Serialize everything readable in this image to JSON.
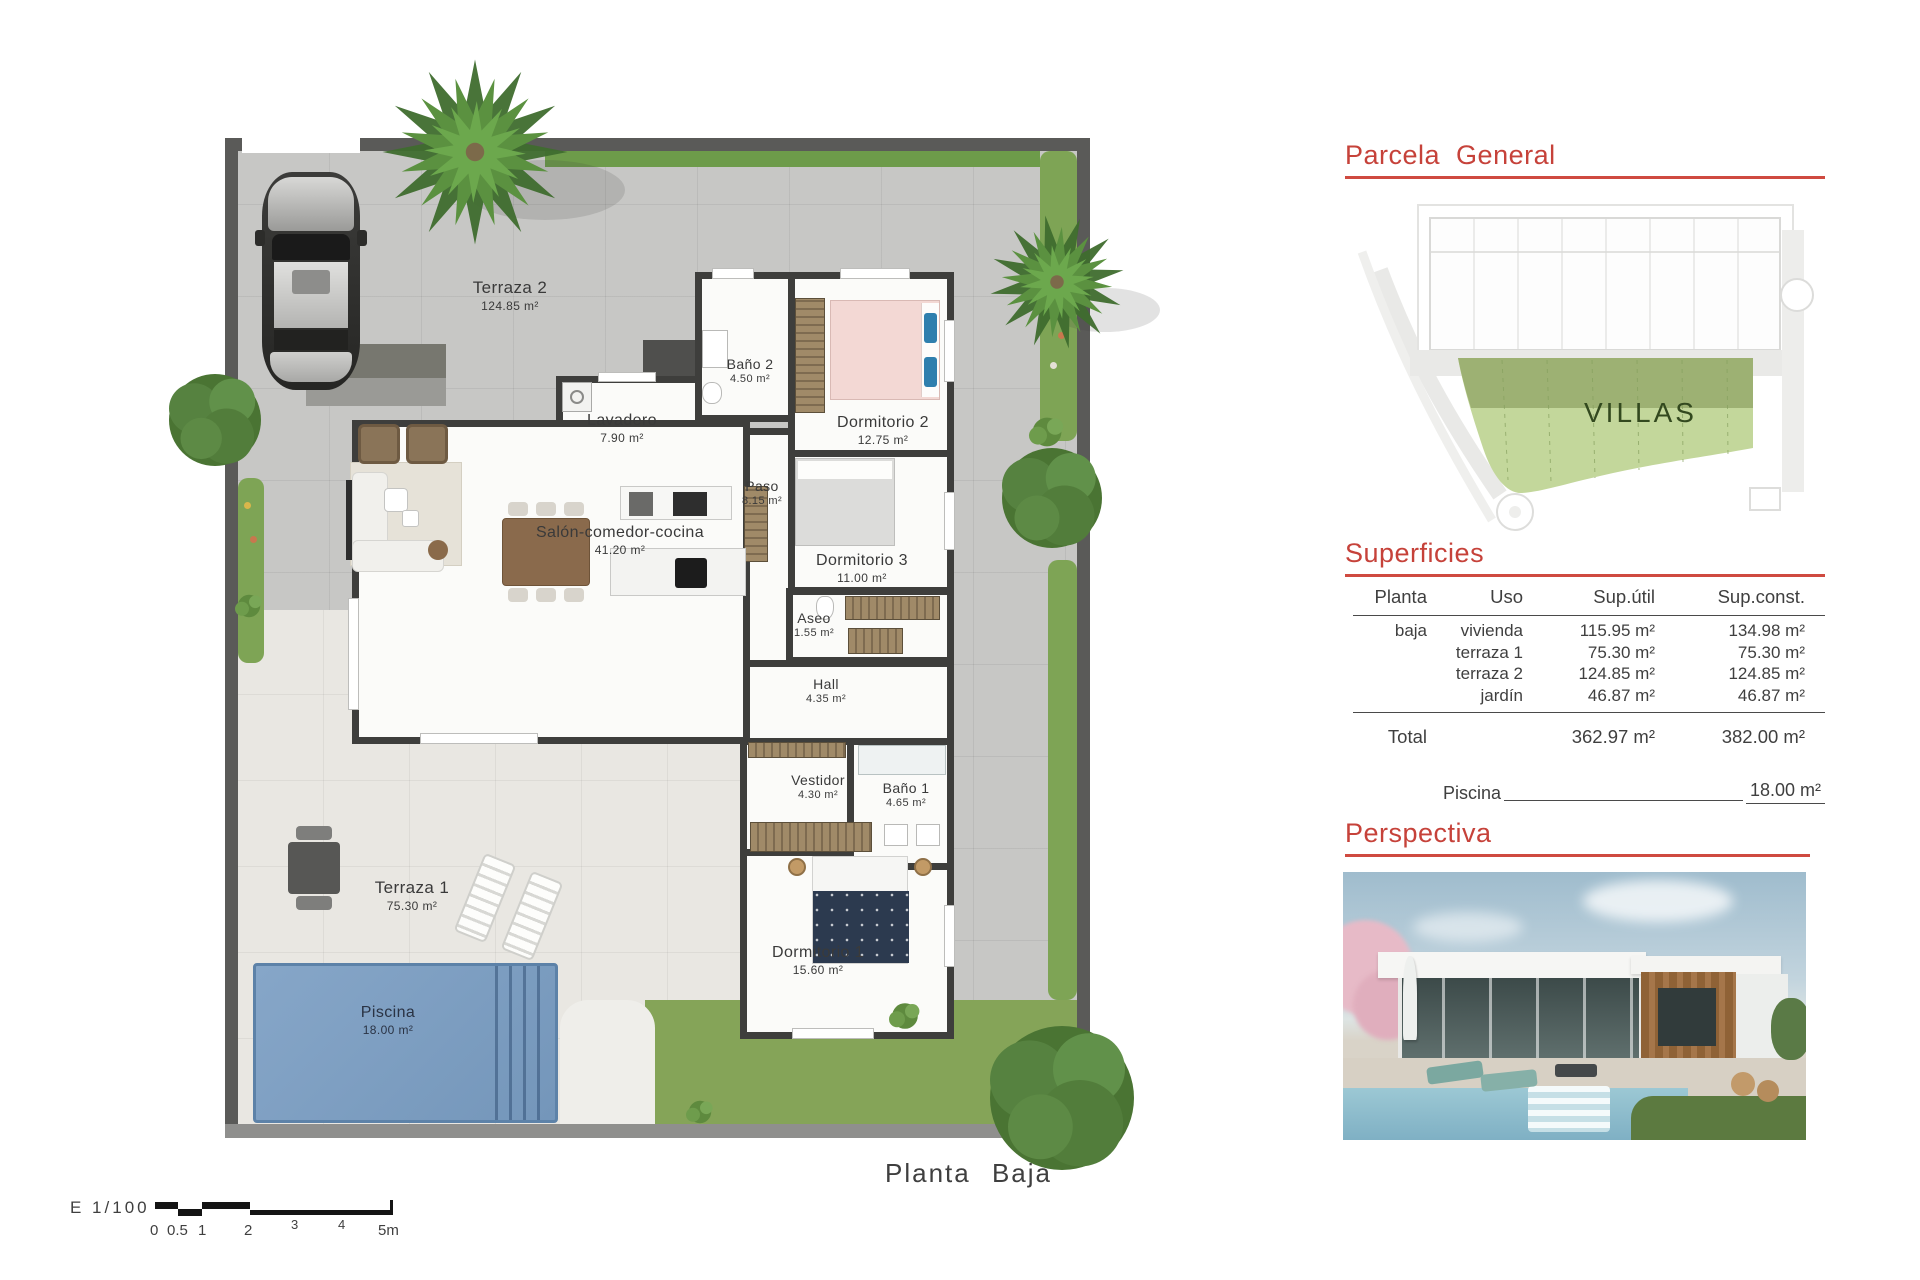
{
  "plan": {
    "caption": "Planta Baja",
    "scale_label": "E 1/100",
    "scale_ticks": [
      "0",
      "0.5",
      "1",
      "2",
      "3",
      "4",
      "5m"
    ],
    "rooms": [
      {
        "name": "Terraza 2",
        "area": "124.85 m²"
      },
      {
        "name": "Baño 2",
        "area": "4.50 m²"
      },
      {
        "name": "Dormitorio 2",
        "area": "12.75 m²"
      },
      {
        "name": "Lavadero",
        "area": "7.90 m²"
      },
      {
        "name": "Paso",
        "area": "8.15 m²"
      },
      {
        "name": "Dormitorio 3",
        "area": "11.00 m²"
      },
      {
        "name": "Salón-comedor-cocina",
        "area": "41.20 m²"
      },
      {
        "name": "Aseo",
        "area": "1.55 m²"
      },
      {
        "name": "Hall",
        "area": "4.35 m²"
      },
      {
        "name": "Vestidor",
        "area": "4.30 m²"
      },
      {
        "name": "Baño 1",
        "area": "4.65 m²"
      },
      {
        "name": "Terraza 1",
        "area": "75.30 m²"
      },
      {
        "name": "Dormitorio 1",
        "area": "15.60 m²"
      },
      {
        "name": "Piscina",
        "area": "18.00 m²"
      }
    ]
  },
  "panel": {
    "parcela": {
      "title": "Parcela General",
      "zone_label": "VILLAS"
    },
    "superficies": {
      "title": "Superficies",
      "headers": [
        "Planta",
        "Uso",
        "Sup.útil",
        "Sup.const."
      ],
      "rows": [
        {
          "planta": "baja",
          "uso": "vivienda",
          "util": "115.95 m²",
          "con": "134.98 m²"
        },
        {
          "planta": "",
          "uso": "terraza 1",
          "util": "75.30 m²",
          "con": "75.30 m²"
        },
        {
          "planta": "",
          "uso": "terraza 2",
          "util": "124.85 m²",
          "con": "124.85 m²"
        },
        {
          "planta": "",
          "uso": "jardín",
          "util": "46.87 m²",
          "con": "46.87 m²"
        }
      ],
      "total": {
        "label": "Total",
        "util": "362.97 m²",
        "con": "382.00 m²"
      },
      "piscina": {
        "label": "Piscina",
        "value": "18.00 m²"
      }
    },
    "perspectiva": {
      "title": "Perspectiva"
    }
  },
  "colors": {
    "accent_red": "#c6423a",
    "villas_green_dark": "#9db173",
    "villas_green_light": "#c3d79b",
    "pool_blue": "#7e9fc2"
  }
}
